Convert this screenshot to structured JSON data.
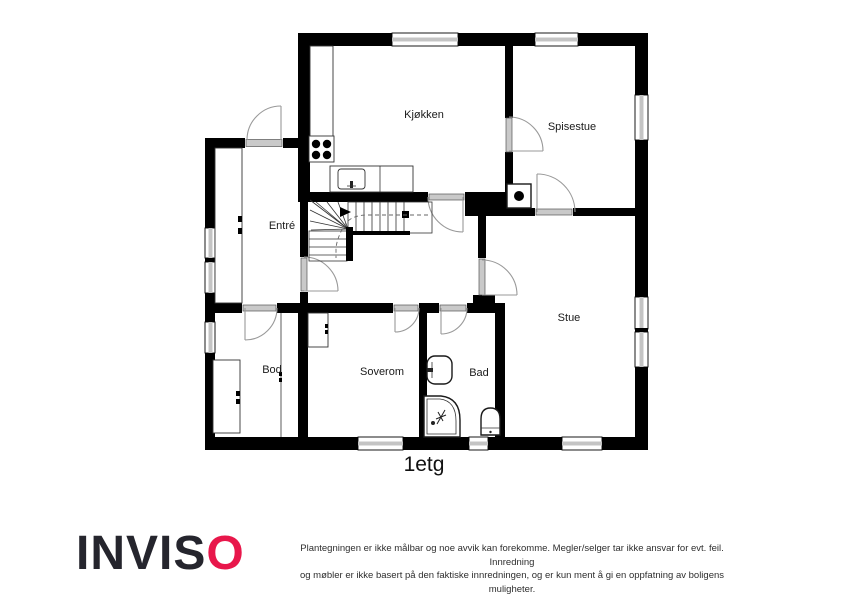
{
  "plan": {
    "title": "1etg",
    "rooms": {
      "kitchen": "Kjøkken",
      "dining": "Spisestue",
      "entry": "Entré",
      "living": "Stue",
      "storage": "Bod",
      "bedroom": "Soverom",
      "bathroom": "Bad"
    },
    "fixtures": [
      "stove",
      "kitchen-sink",
      "kitchen-counter",
      "fireplace",
      "staircase",
      "wardrobe-entry",
      "wardrobe-bedroom",
      "wardrobe-storage",
      "bathroom-sink",
      "shower",
      "toilet"
    ]
  },
  "footer": {
    "logo_prefix": "INVIS",
    "logo_suffix": "O",
    "disclaimer_line1": "Plantegningen er ikke målbar og noe avvik kan forekomme. Megler/selger tar ikke ansvar for evt. feil. Innredning",
    "disclaimer_line2": "og møbler er ikke basert på den faktiske innredningen, og er kun ment å gi en oppfatning av boligens muligheter."
  },
  "colors": {
    "wall": "#000000",
    "window_fill": "#c4c4c4",
    "door_leaf": "#c9c9c9",
    "arc": "#999999",
    "logo_dark": "#25252d",
    "logo_accent": "#e8174b",
    "text": "#1a1a1a"
  }
}
